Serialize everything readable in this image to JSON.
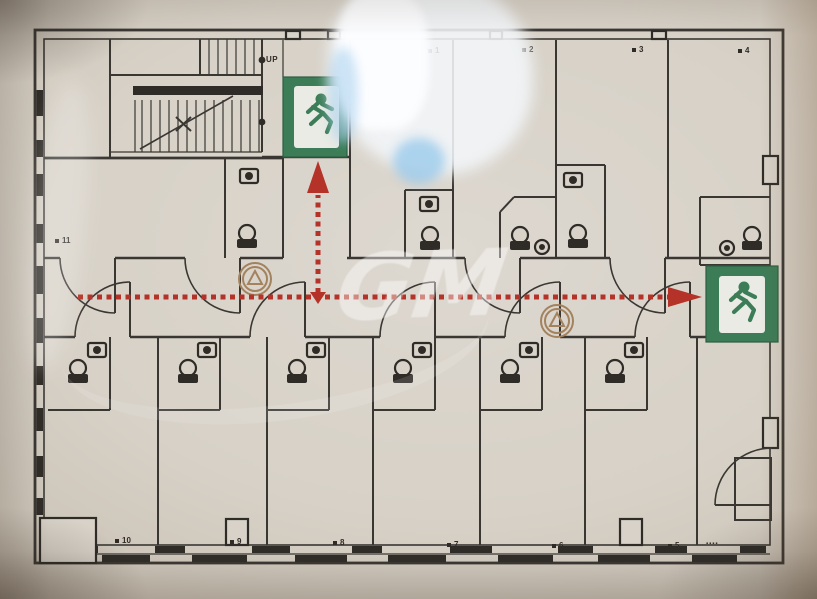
{
  "photo": {
    "description": "photo of building evacuation floor plan",
    "watermark": "GM"
  },
  "plan": {
    "stairs": {
      "up_label": "UP"
    },
    "rooms": [
      {
        "label": "1"
      },
      {
        "label": "2"
      },
      {
        "label": "3"
      },
      {
        "label": "4"
      },
      {
        "label": "5"
      },
      {
        "label": "6"
      },
      {
        "label": "7"
      },
      {
        "label": "8"
      },
      {
        "label": "9"
      },
      {
        "label": "10"
      },
      {
        "label": "11"
      }
    ],
    "corner_small_text": "▪▪▪▪",
    "exits": {
      "top": "emergency-exit-sign",
      "right": "emergency-exit-sign"
    },
    "route": {
      "style": "red-dotted-line",
      "arrows": [
        "up-to-top-exit",
        "right-to-right-exit"
      ]
    },
    "colors": {
      "exit_green": "#3c7d58",
      "route_red": "#b43227",
      "wall_line": "#3a3733",
      "paper": "#d8d2c9",
      "extinguisher_symbol": "#a3825e"
    },
    "icons": {
      "exit": "running-man-exit-pictogram",
      "extinguisher": "fire-extinguisher-circle-symbol",
      "toilet": "toilet-top-view",
      "sink": "washbasin-top-view",
      "room_marker": "small-black-square"
    }
  }
}
